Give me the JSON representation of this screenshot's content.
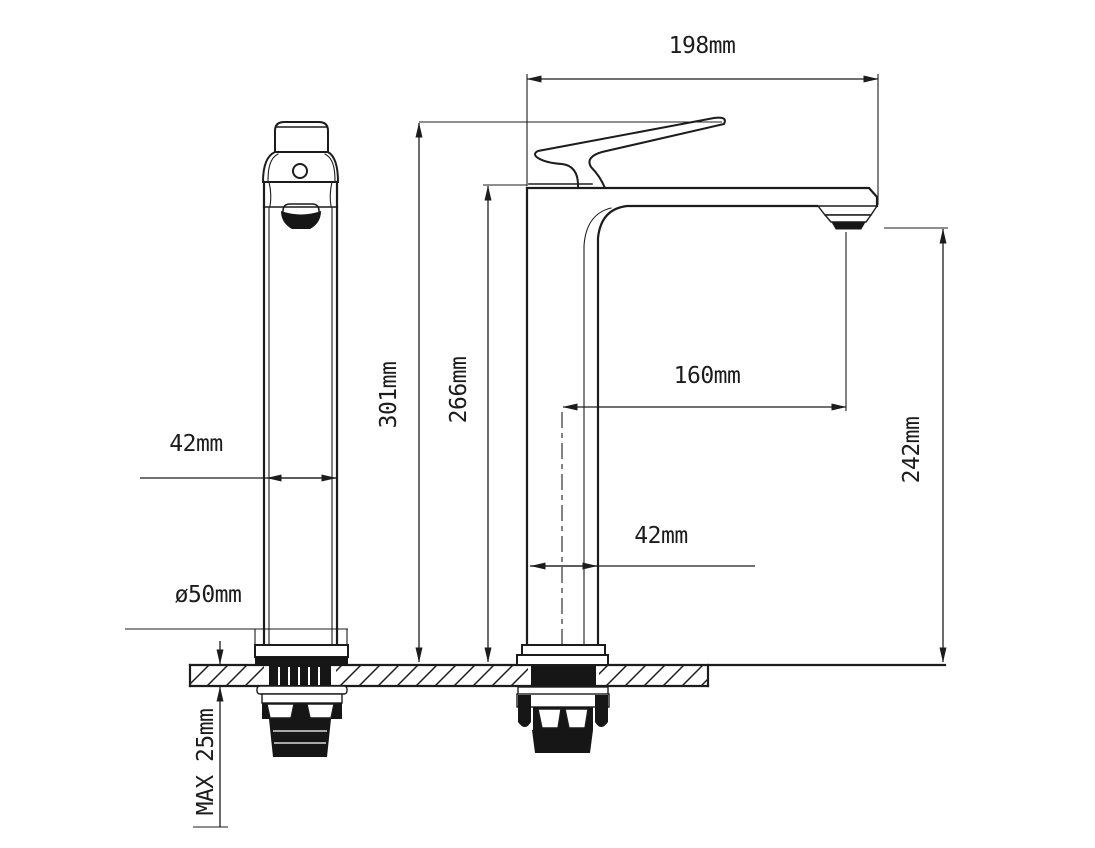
{
  "drawing": {
    "colors": {
      "line": "#1c1c1c",
      "background": "#ffffff"
    },
    "dimensions": {
      "spout_width": "198mm",
      "overall_height": "301mm",
      "deck_height": "266mm",
      "spout_reach": "160mm",
      "outlet_height": "242mm",
      "body_width_front": "42mm",
      "body_width_side": "42mm",
      "base_diameter": "ø50mm",
      "max_deck_thickness": "MAX 25mm"
    }
  }
}
